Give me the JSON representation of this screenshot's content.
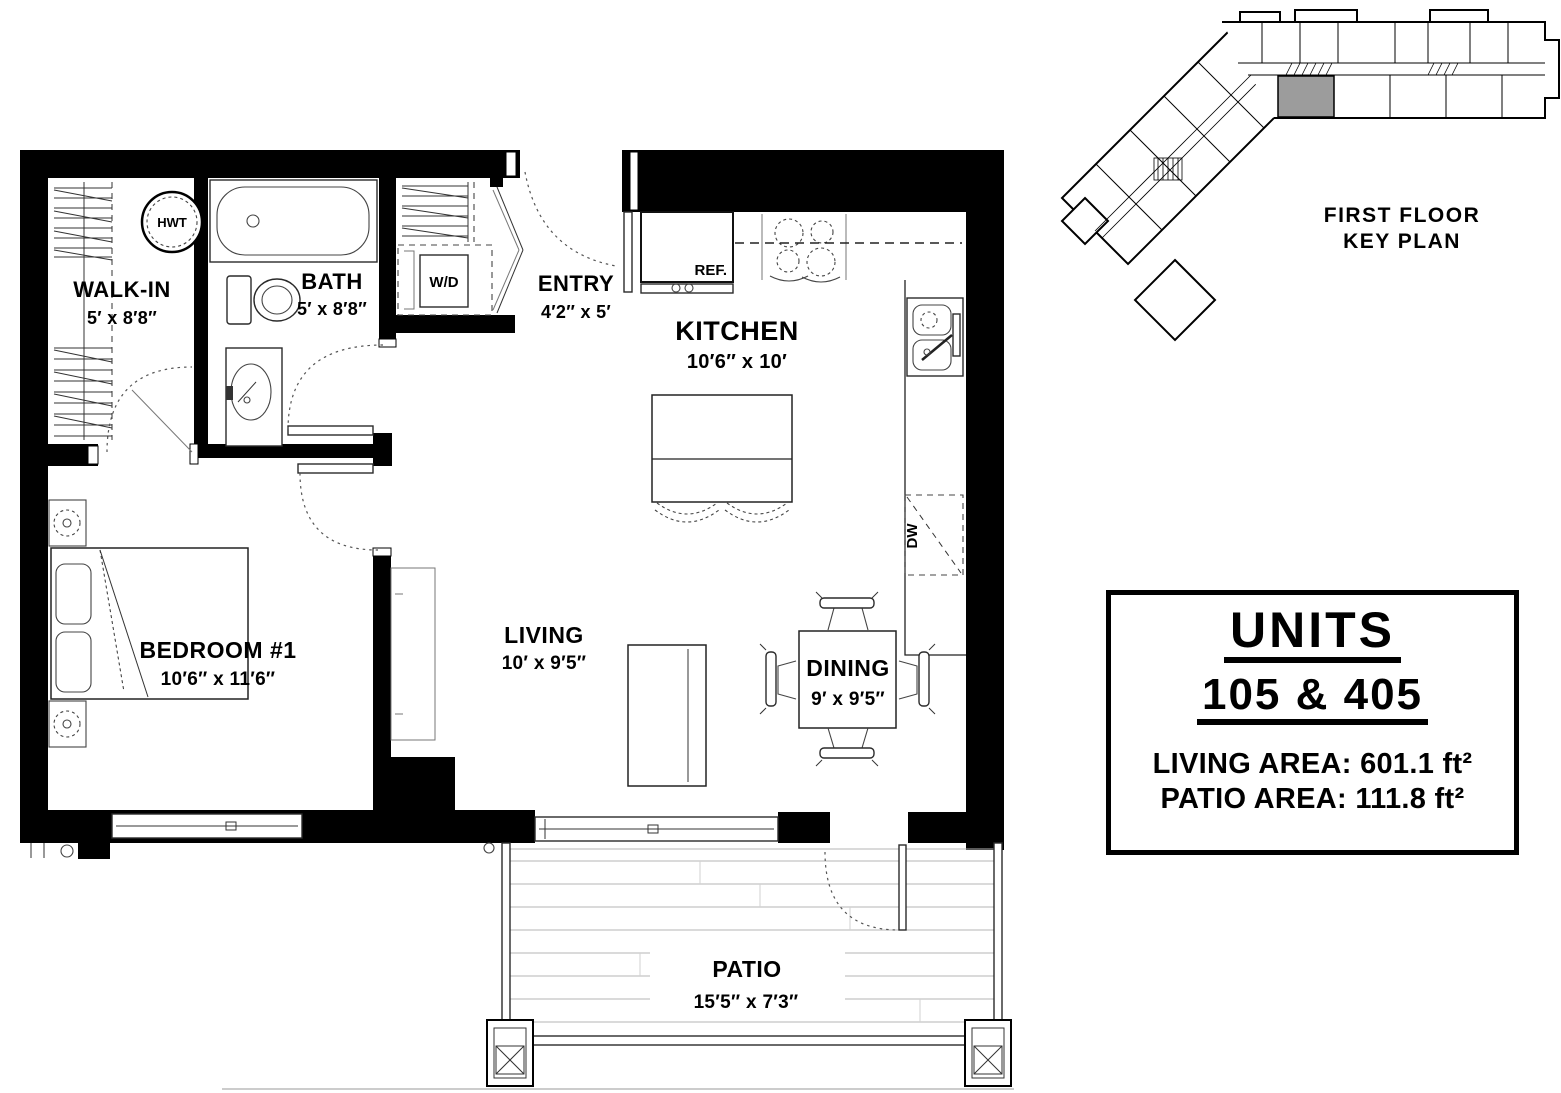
{
  "plan": {
    "rooms": [
      {
        "name": "WALK-IN",
        "dims": "5′ x 8′8″"
      },
      {
        "name": "BATH",
        "dims": "5′ x 8′8″"
      },
      {
        "name": "ENTRY",
        "dims": "4′2″ x 5′"
      },
      {
        "name": "KITCHEN",
        "dims": "10′6″ x 10′"
      },
      {
        "name": "BEDROOM #1",
        "dims": "10′6″ x 11′6″"
      },
      {
        "name": "LIVING",
        "dims": "10′ x 9′5″"
      },
      {
        "name": "DINING",
        "dims": "9′ x 9′5″"
      },
      {
        "name": "PATIO",
        "dims": "15′5″ x 7′3″"
      }
    ],
    "fixtures": {
      "hwt": "HWT",
      "washer_dryer": "W/D",
      "refrigerator": "REF.",
      "dishwasher": "DW"
    }
  },
  "key_plan": {
    "title_line1": "FIRST FLOOR",
    "title_line2": "KEY PLAN",
    "highlight_color": "#9c9c9c"
  },
  "info_box": {
    "title": "UNITS",
    "units": "105 & 405",
    "living_area_label": "LIVING AREA:",
    "living_area_value": "601.1 ft²",
    "patio_area_label": "PATIO AREA:",
    "patio_area_value": "111.8 ft²"
  }
}
